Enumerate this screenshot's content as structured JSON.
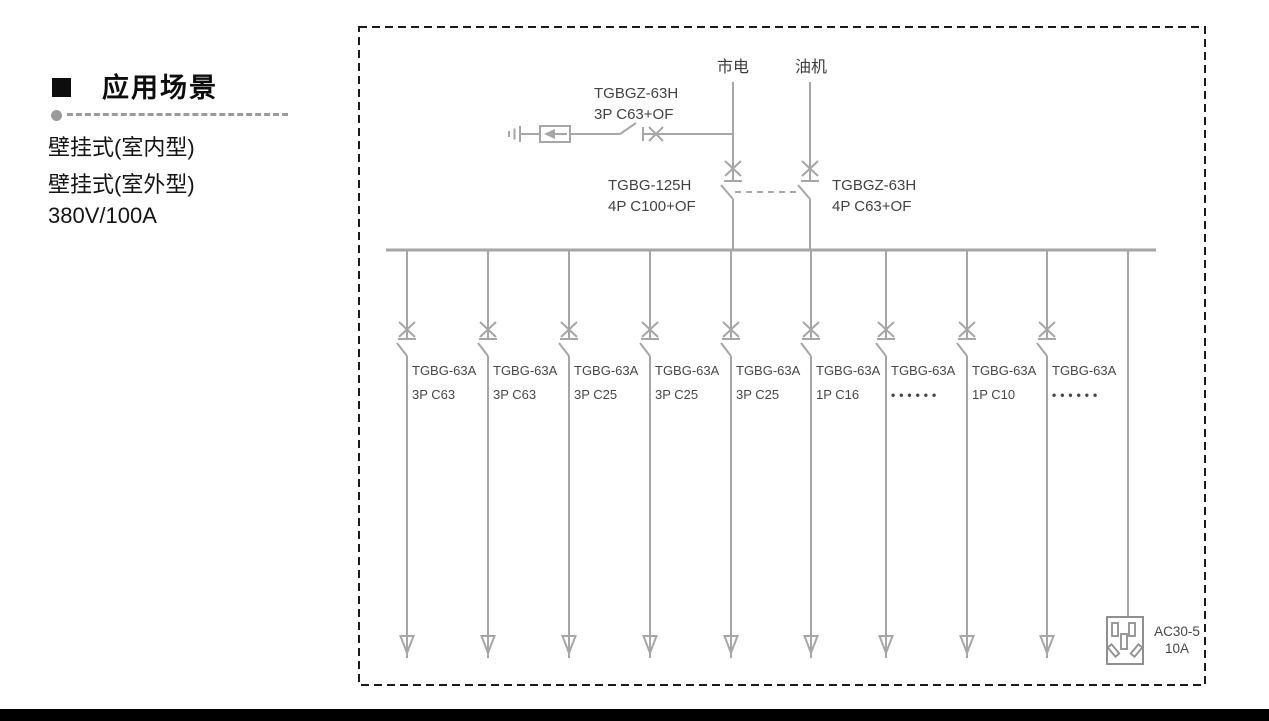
{
  "sidebar": {
    "heading": "应用场景",
    "items": [
      {
        "label": "壁挂式(室内型)"
      },
      {
        "label": "壁挂式(室外型)"
      },
      {
        "label": "380V/100A"
      }
    ]
  },
  "diagram": {
    "mains_label": "市电",
    "generator_label": "油机",
    "spd_breaker": {
      "model": "TGBGZ-63H",
      "spec": "3P C63+OF"
    },
    "mains_breaker": {
      "model": "TGBG-125H",
      "spec": "4P C100+OF"
    },
    "generator_breaker": {
      "model": "TGBGZ-63H",
      "spec": "4P C63+OF"
    },
    "branches": [
      {
        "model": "TGBG-63A",
        "spec": "3P C63"
      },
      {
        "model": "TGBG-63A",
        "spec": "3P C63"
      },
      {
        "model": "TGBG-63A",
        "spec": "3P C25"
      },
      {
        "model": "TGBG-63A",
        "spec": "3P C25"
      },
      {
        "model": "TGBG-63A",
        "spec": "3P C25"
      },
      {
        "model": "TGBG-63A",
        "spec": "1P C16"
      },
      {
        "model": "TGBG-63A",
        "spec": "••••••"
      },
      {
        "model": "TGBG-63A",
        "spec": "1P C10"
      },
      {
        "model": "TGBG-63A",
        "spec": "••••••"
      }
    ],
    "socket": {
      "model": "AC30-5",
      "rating": "10A"
    }
  },
  "colors": {
    "line": "#a6a6a6",
    "socket_line": "#8f8f8f",
    "border": "#1a1a1a",
    "text": "#424242"
  }
}
